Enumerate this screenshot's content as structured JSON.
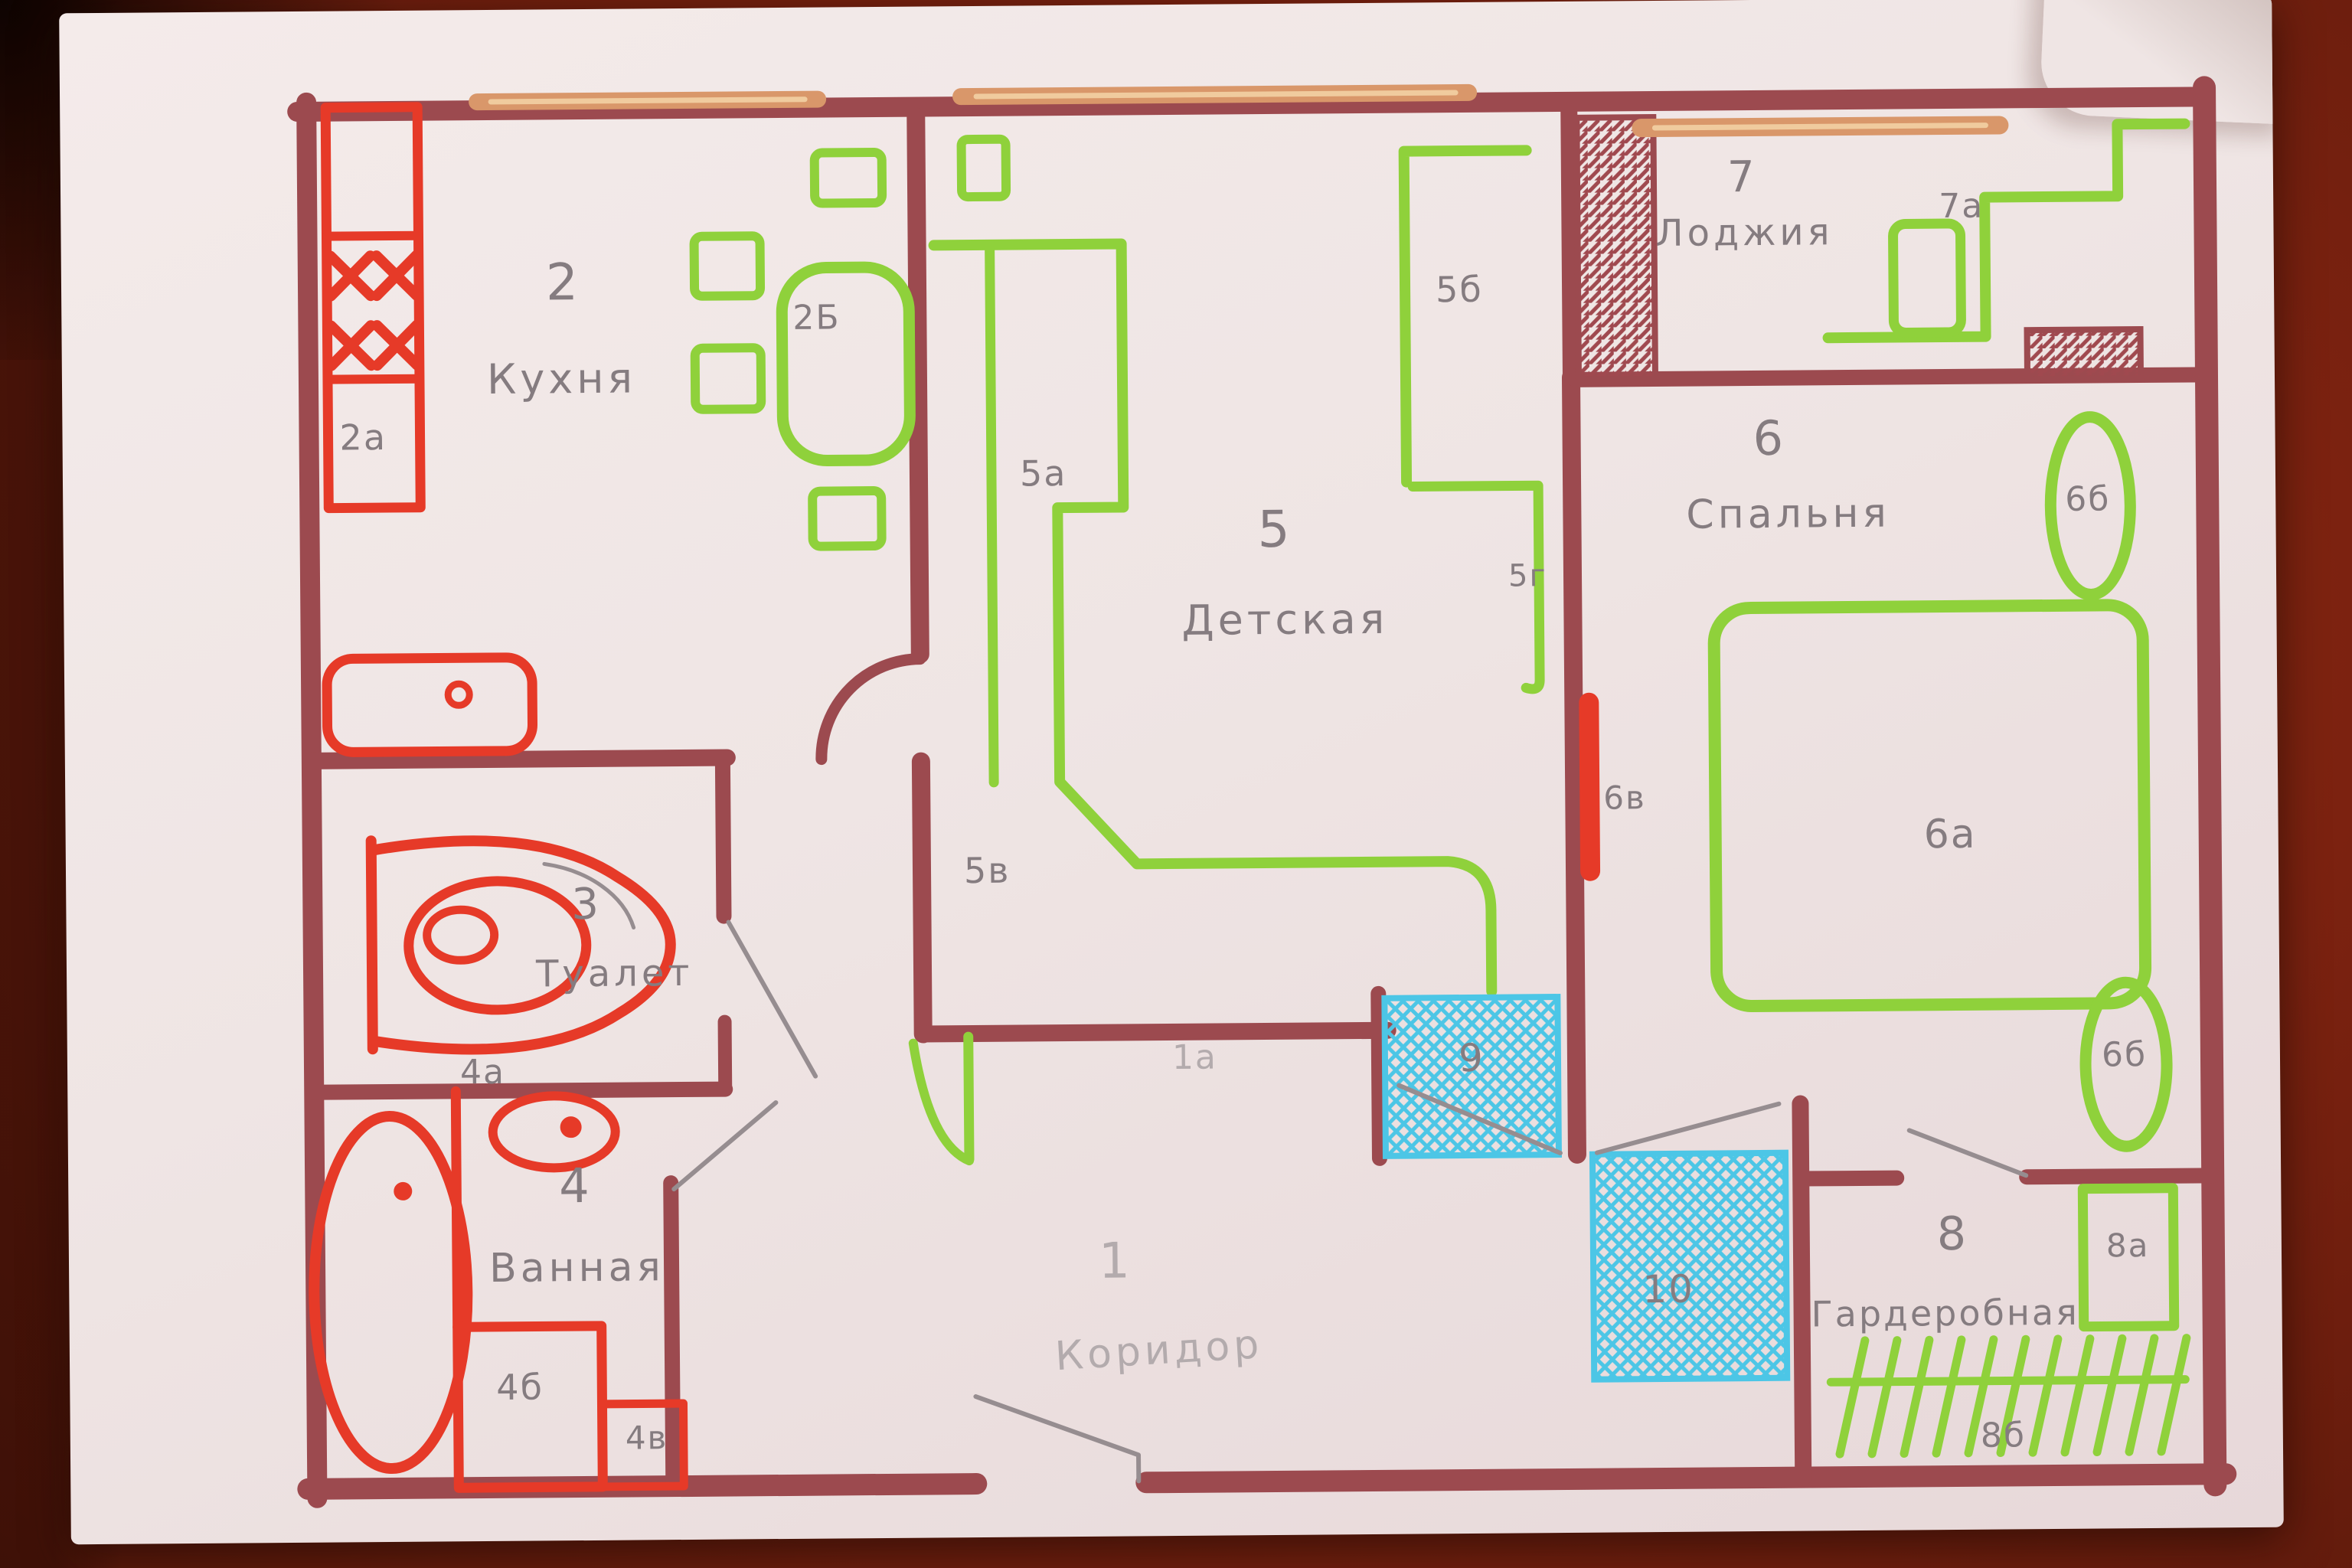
{
  "colors": {
    "wall": "#9c4a4f",
    "fixture_red": "#e63a28",
    "furniture_green": "#8fd13b",
    "water_blue": "#4cc6e6",
    "window_tan": "#d9976a",
    "pencil_gray": "#8a8184",
    "paper": "#efe5e4",
    "table_wood": "#7c2210"
  },
  "rooms": [
    {
      "number": "1",
      "name": "Коридор",
      "sublabels": [
        "1а"
      ]
    },
    {
      "number": "2",
      "name": "Кухня",
      "sublabels": [
        "2а",
        "2Б"
      ]
    },
    {
      "number": "3",
      "name": "Туалет",
      "sublabels": []
    },
    {
      "number": "4",
      "name": "Ванная",
      "sublabels": [
        "4а",
        "4б",
        "4в"
      ]
    },
    {
      "number": "5",
      "name": "Детская",
      "sublabels": [
        "5а",
        "5б",
        "5в",
        "5г"
      ]
    },
    {
      "number": "6",
      "name": "Спальня",
      "sublabels": [
        "6а",
        "6б",
        "6б",
        "6в"
      ]
    },
    {
      "number": "7",
      "name": "Лоджия",
      "sublabels": [
        "7а"
      ]
    },
    {
      "number": "8",
      "name": "Гардеробная",
      "sublabels": [
        "8а",
        "8б"
      ]
    },
    {
      "number": "9",
      "name": "",
      "sublabels": []
    },
    {
      "number": "10",
      "name": "",
      "sublabels": []
    }
  ],
  "labels": {
    "r1num": "1",
    "r1name": "Коридор",
    "l1a": "1а",
    "r2num": "2",
    "r2name": "Кухня",
    "l2a": "2а",
    "l2b": "2Б",
    "r3num": "3",
    "r3name": "Туалет",
    "l4a": "4а",
    "r4num": "4",
    "r4name": "Ванная",
    "l4b": "4б",
    "l4v": "4в",
    "r5num": "5",
    "r5name": "Детская",
    "l5a": "5а",
    "l5b": "5б",
    "l5v": "5в",
    "l5g": "5г",
    "r6num": "6",
    "r6name": "Спальня",
    "l6a": "6а",
    "l6b1": "6б",
    "l6b2": "6б",
    "l6v": "6в",
    "r7num": "7",
    "r7name": "Лоджия",
    "l7a": "7а",
    "r8num": "8",
    "r8name": "Гардеробная",
    "l8a": "8а",
    "l8b": "8б",
    "l9": "9",
    "l10": "10"
  }
}
